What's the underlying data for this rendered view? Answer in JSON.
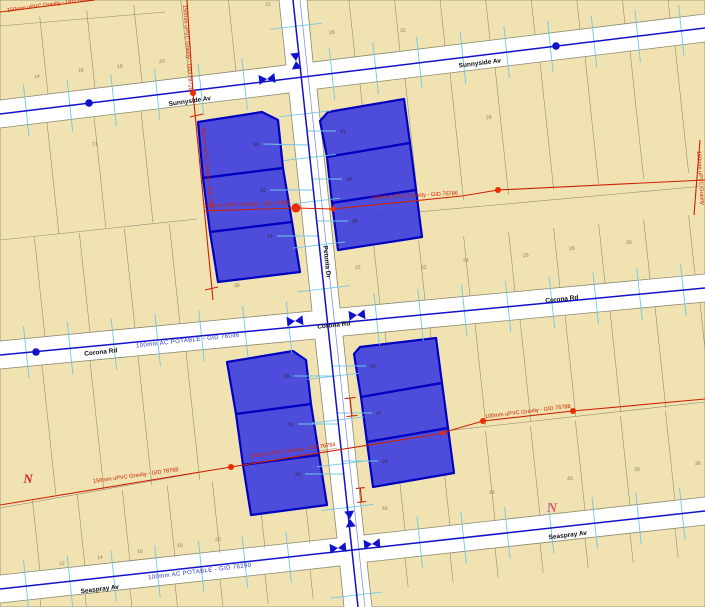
{
  "map": {
    "canvas": {
      "w": 705,
      "h": 607,
      "bg": "#ffffff"
    },
    "colors": {
      "block_fill": "#f1e2b2",
      "line": "#8a8a70",
      "selected_fill": "#4444dd",
      "selected_stroke": "#0000c0",
      "water_main": "#1111cc",
      "petunia_secondary": "#8893d6",
      "service": "#70c8e8",
      "gravity": "#cc2200",
      "gravity_dot": "#ee2b00",
      "street_text": "#101010",
      "potable_text": "#2a35cc",
      "lot_text": "#8f7f5a",
      "selected_lot_text": "#2a2a3a"
    },
    "blocks": [
      {
        "points": "0,0 279,0 286,65 0,100"
      },
      {
        "points": "307,0 705,0 705,14 313,62"
      },
      {
        "points": "0,128 289,93 312,311 0,341"
      },
      {
        "points": "317,89 705,42 705,274 340,308"
      },
      {
        "points": "0,369 315,339 337,538 0,575"
      },
      {
        "points": "343,336 705,302 705,497 364,535"
      },
      {
        "points": "0,603 340,566 344,607 0,607"
      },
      {
        "points": "367,562 705,525 705,607 372,607"
      }
    ],
    "lot_rows": [
      {
        "edge": [
          [
            0,
            100
          ],
          [
            286,
            65
          ]
        ],
        "xs": [
          48,
          95,
          142,
          189,
          236
        ],
        "depth": -78
      },
      {
        "edge": [
          [
            313,
            62
          ],
          [
            705,
            14
          ]
        ],
        "xs": [
          355,
          400,
          445,
          490,
          535,
          580,
          625,
          670
        ],
        "depth": -65
      },
      {
        "edge": [
          [
            0,
            128
          ],
          [
            289,
            93
          ]
        ],
        "xs": [
          47,
          94,
          141
        ],
        "depth": 112
      },
      {
        "edge": [
          [
            0,
            341
          ],
          [
            312,
            311
          ]
        ],
        "xs": [
          45,
          90,
          135,
          180
        ],
        "depth": -100
      },
      {
        "edge": [
          [
            317,
            89
          ],
          [
            705,
            42
          ]
        ],
        "xs": [
          360,
          405,
          450,
          495,
          540,
          585,
          630,
          675
        ],
        "depth": 128
      },
      {
        "edge": [
          [
            340,
            308
          ],
          [
            705,
            274
          ]
        ],
        "xs": [
          380,
          425,
          470,
          515,
          560,
          605,
          650,
          695
        ],
        "depth": -60
      },
      {
        "edge": [
          [
            0,
            369
          ],
          [
            315,
            339
          ]
        ],
        "xs": [
          42,
          90,
          138,
          186
        ],
        "depth": 130
      },
      {
        "edge": [
          [
            0,
            575
          ],
          [
            337,
            541
          ]
        ],
        "xs": [
          40,
          85,
          130,
          175,
          220,
          265,
          310
        ],
        "depth": -72
      },
      {
        "edge": [
          [
            343,
            336
          ],
          [
            705,
            302
          ]
        ],
        "xs": [
          385,
          430,
          475,
          520,
          565,
          610,
          655,
          700
        ],
        "depth": 102
      },
      {
        "edge": [
          [
            364,
            535
          ],
          [
            705,
            497
          ]
        ],
        "xs": [
          405,
          450,
          495,
          540,
          585,
          630,
          675
        ],
        "depth": -90
      },
      {
        "edge": [
          [
            0,
            603
          ],
          [
            340,
            566
          ]
        ],
        "xs": [
          40,
          85,
          130,
          175,
          220,
          265,
          310
        ],
        "depth": 30
      },
      {
        "edge": [
          [
            367,
            562
          ],
          [
            705,
            525
          ]
        ],
        "xs": [
          405,
          450,
          495,
          540,
          585,
          630,
          675
        ],
        "depth": 30
      }
    ],
    "extra_lines": [
      [
        [
          0,
          26
        ],
        [
          165,
          12
        ]
      ],
      [
        [
          0,
          240
        ],
        [
          197,
          219
        ]
      ],
      [
        [
          340,
          219
        ],
        [
          705,
          186
        ]
      ],
      [
        [
          0,
          508
        ],
        [
          337,
          448
        ]
      ],
      [
        [
          365,
          440
        ],
        [
          705,
          402
        ]
      ]
    ],
    "lot_numbers": [
      [
        "14",
        37,
        78
      ],
      [
        "16",
        81,
        72
      ],
      [
        "18",
        120,
        68
      ],
      [
        "20",
        162,
        63
      ],
      [
        "22",
        268,
        6
      ],
      [
        "28",
        332,
        34
      ],
      [
        "22",
        403,
        32
      ],
      [
        "71",
        95,
        146
      ],
      [
        "36",
        237,
        287
      ],
      [
        "29",
        489,
        119
      ],
      [
        "22",
        358,
        269
      ],
      [
        "22",
        424,
        269
      ],
      [
        "24",
        466,
        262
      ],
      [
        "26",
        526,
        257
      ],
      [
        "28",
        572,
        250
      ],
      [
        "30",
        629,
        244
      ],
      [
        "20",
        218,
        541
      ],
      [
        "18",
        180,
        547
      ],
      [
        "16",
        140,
        553
      ],
      [
        "14",
        100,
        559
      ],
      [
        "12",
        62,
        565
      ],
      [
        "46",
        385,
        510
      ],
      [
        "45",
        492,
        494
      ],
      [
        "40",
        570,
        480
      ],
      [
        "38",
        637,
        471
      ],
      [
        "36",
        698,
        465
      ]
    ],
    "selected_parcels": [
      {
        "points": "198,122 262,112 278,120 283,168 203,178",
        "n": "30",
        "x": 256,
        "y": 146,
        "lx": 308,
        "ly": 145
      },
      {
        "points": "203,178 283,168 292,222 210,232",
        "n": "12",
        "x": 263,
        "y": 192,
        "lx": 313,
        "ly": 190
      },
      {
        "points": "210,232 292,222 300,272 218,282",
        "n": "14",
        "x": 270,
        "y": 238,
        "lx": 318,
        "ly": 236
      },
      {
        "points": "320,121 328,112 404,99 410,143 327,157",
        "n": "41",
        "x": 343,
        "y": 133,
        "lx": 307,
        "ly": 131
      },
      {
        "points": "327,157 410,143 416,190 332,203",
        "n": "39",
        "x": 349,
        "y": 181,
        "lx": 312,
        "ly": 179
      },
      {
        "points": "332,203 416,190 422,237 338,250",
        "n": "35",
        "x": 355,
        "y": 223,
        "lx": 317,
        "ly": 221
      },
      {
        "points": "227,362 293,351 306,360 311,404 236,414",
        "n": "35",
        "x": 287,
        "y": 378,
        "lx": 333,
        "ly": 376
      },
      {
        "points": "236,414 311,404 319,455 243,465",
        "n": "41",
        "x": 291,
        "y": 426,
        "lx": 338,
        "ly": 424
      },
      {
        "points": "243,465 319,455 327,505 251,515",
        "n": "43",
        "x": 298,
        "y": 476,
        "lx": 344,
        "ly": 474
      },
      {
        "points": "354,354 360,347 436,338 442,383 361,397",
        "n": "55",
        "x": 373,
        "y": 368,
        "lx": 332,
        "ly": 366
      },
      {
        "points": "361,397 442,383 448,428 367,442",
        "n": "47",
        "x": 379,
        "y": 415,
        "lx": 337,
        "ly": 413
      },
      {
        "points": "367,442 448,428 454,473 373,487",
        "n": "33",
        "x": 385,
        "y": 463,
        "lx": 342,
        "ly": 461
      }
    ],
    "water_mains": [
      {
        "pts": [
          [
            0,
            114
          ],
          [
            705,
            28
          ]
        ],
        "skip": [
          300
        ],
        "dir": [
          0.106,
          0.994
        ],
        "axis": "x"
      },
      {
        "pts": [
          [
            0,
            355
          ],
          [
            705,
            288
          ]
        ],
        "skip": [
          327
        ],
        "dir": [
          0.106,
          0.994
        ],
        "axis": "x"
      },
      {
        "pts": [
          [
            0,
            589
          ],
          [
            705,
            511
          ]
        ],
        "skip": [
          352
        ],
        "dir": [
          0.106,
          0.994
        ],
        "axis": "x"
      },
      {
        "pts": [
          [
            293,
            0
          ],
          [
            358,
            607
          ]
        ],
        "skip": [
          77,
          324,
          550
        ],
        "dir": [
          0.993,
          -0.116
        ],
        "axis": "y"
      }
    ],
    "petunia_secondary_line": [
      [
        300,
        0
      ],
      [
        365,
        607
      ]
    ],
    "tick": {
      "spacing": 44,
      "length": 26,
      "clearance": 30
    },
    "water_nodes": [
      [
        89,
        103
      ],
      [
        556,
        46
      ],
      [
        36,
        352
      ]
    ],
    "valves": [
      {
        "x": 296,
        "y": 61,
        "r": 84
      },
      {
        "x": 267,
        "y": 79,
        "r": -7
      },
      {
        "x": 295,
        "y": 321,
        "r": -6
      },
      {
        "x": 357,
        "y": 315,
        "r": -6
      },
      {
        "x": 350,
        "y": 519,
        "r": 84
      },
      {
        "x": 338,
        "y": 548,
        "r": -6
      },
      {
        "x": 372,
        "y": 544,
        "r": -6
      }
    ],
    "gravity_lines": [
      [
        [
          0,
          12
        ],
        [
          95,
          0
        ]
      ],
      [
        [
          187,
          0
        ],
        [
          193,
          93
        ]
      ],
      [
        [
          193,
          93
        ],
        [
          213,
          300
        ]
      ],
      [
        [
          190,
          117
        ],
        [
          203,
          114
        ]
      ],
      [
        [
          205,
          290
        ],
        [
          218,
          287
        ]
      ],
      [
        [
          204,
          211
        ],
        [
          296,
          208
        ],
        [
          333,
          209
        ],
        [
          462,
          196
        ],
        [
          498,
          190
        ],
        [
          705,
          180
        ]
      ],
      [
        [
          694,
          215
        ],
        [
          700,
          140
        ]
      ],
      [
        [
          0,
          505
        ],
        [
          231,
          467
        ],
        [
          438,
          434
        ],
        [
          483,
          421
        ],
        [
          573,
          411
        ],
        [
          705,
          399
        ]
      ]
    ],
    "gravity_dots": [
      [
        193,
        93,
        3
      ],
      [
        296,
        208,
        4.5
      ],
      [
        333,
        209,
        2.6
      ],
      [
        498,
        190,
        3
      ],
      [
        231,
        467,
        3
      ],
      [
        443,
        433,
        2.4
      ],
      [
        483,
        421,
        3
      ],
      [
        573,
        411,
        3
      ]
    ],
    "gravity_marks": [
      {
        "x": 351,
        "y": 407,
        "r": 84,
        "len": 18,
        "cap": 11
      },
      {
        "x": 361,
        "y": 495,
        "r": 84,
        "len": 14,
        "cap": 9
      }
    ],
    "gravity_labels": [
      {
        "t": "150mm uPVC Gravity - GID 78763",
        "x": 50,
        "y": 6,
        "r": -8
      },
      {
        "t": "150mm uPVC Gravity - GID 78728",
        "x": 186,
        "y": 48,
        "r": 86
      },
      {
        "t": "150mm uPVC Gravity - GID 78727",
        "x": 206,
        "y": 170,
        "r": 84
      },
      {
        "t": "100mm uPVC Gravity - GID 76782",
        "x": 247,
        "y": 206,
        "r": -2
      },
      {
        "t": "100mm uPVC Gravity - GID 76786",
        "x": 415,
        "y": 197,
        "r": -3
      },
      {
        "t": "150mm uPVC Gravity",
        "x": 699,
        "y": 178,
        "r": 86
      },
      {
        "t": "100mm uPVC Gravity - GID 76788",
        "x": 528,
        "y": 413,
        "r": -7
      },
      {
        "t": "100mm uPVC Gravity - GID 76784",
        "x": 293,
        "y": 452,
        "r": -8
      },
      {
        "t": "150mm uPVC Gravity - GID 78768",
        "x": 136,
        "y": 477,
        "r": -8
      }
    ],
    "potable_labels": [
      {
        "t": "100mm AC POTABLE - GID 76046",
        "x": 188,
        "y": 342,
        "r": -6
      },
      {
        "t": "100mm AC POTABLE - GID 76290",
        "x": 200,
        "y": 573,
        "r": -7
      }
    ],
    "street_labels": [
      {
        "t": "Sunnyside Av",
        "x": 190,
        "y": 103,
        "r": -8
      },
      {
        "t": "Sunnyside Av",
        "x": 480,
        "y": 65,
        "r": -7
      },
      {
        "t": "Corona Rd",
        "x": 101,
        "y": 354,
        "r": -6
      },
      {
        "t": "Corona Rd",
        "x": 334,
        "y": 327,
        "r": -6
      },
      {
        "t": "Corona Rd",
        "x": 562,
        "y": 301,
        "r": -6
      },
      {
        "t": "Petunia Dr",
        "x": 325,
        "y": 262,
        "r": 84
      },
      {
        "t": "Seaspray Av",
        "x": 100,
        "y": 591,
        "r": -7
      },
      {
        "t": "Seaspray Av",
        "x": 568,
        "y": 537,
        "r": -7
      }
    ],
    "north_marks": [
      {
        "t": "N",
        "x": 28,
        "y": 483,
        "s": 13,
        "c": "#cc2936"
      },
      {
        "t": "N",
        "x": 552,
        "y": 512,
        "s": 14,
        "c": "#e05a6a"
      }
    ]
  }
}
